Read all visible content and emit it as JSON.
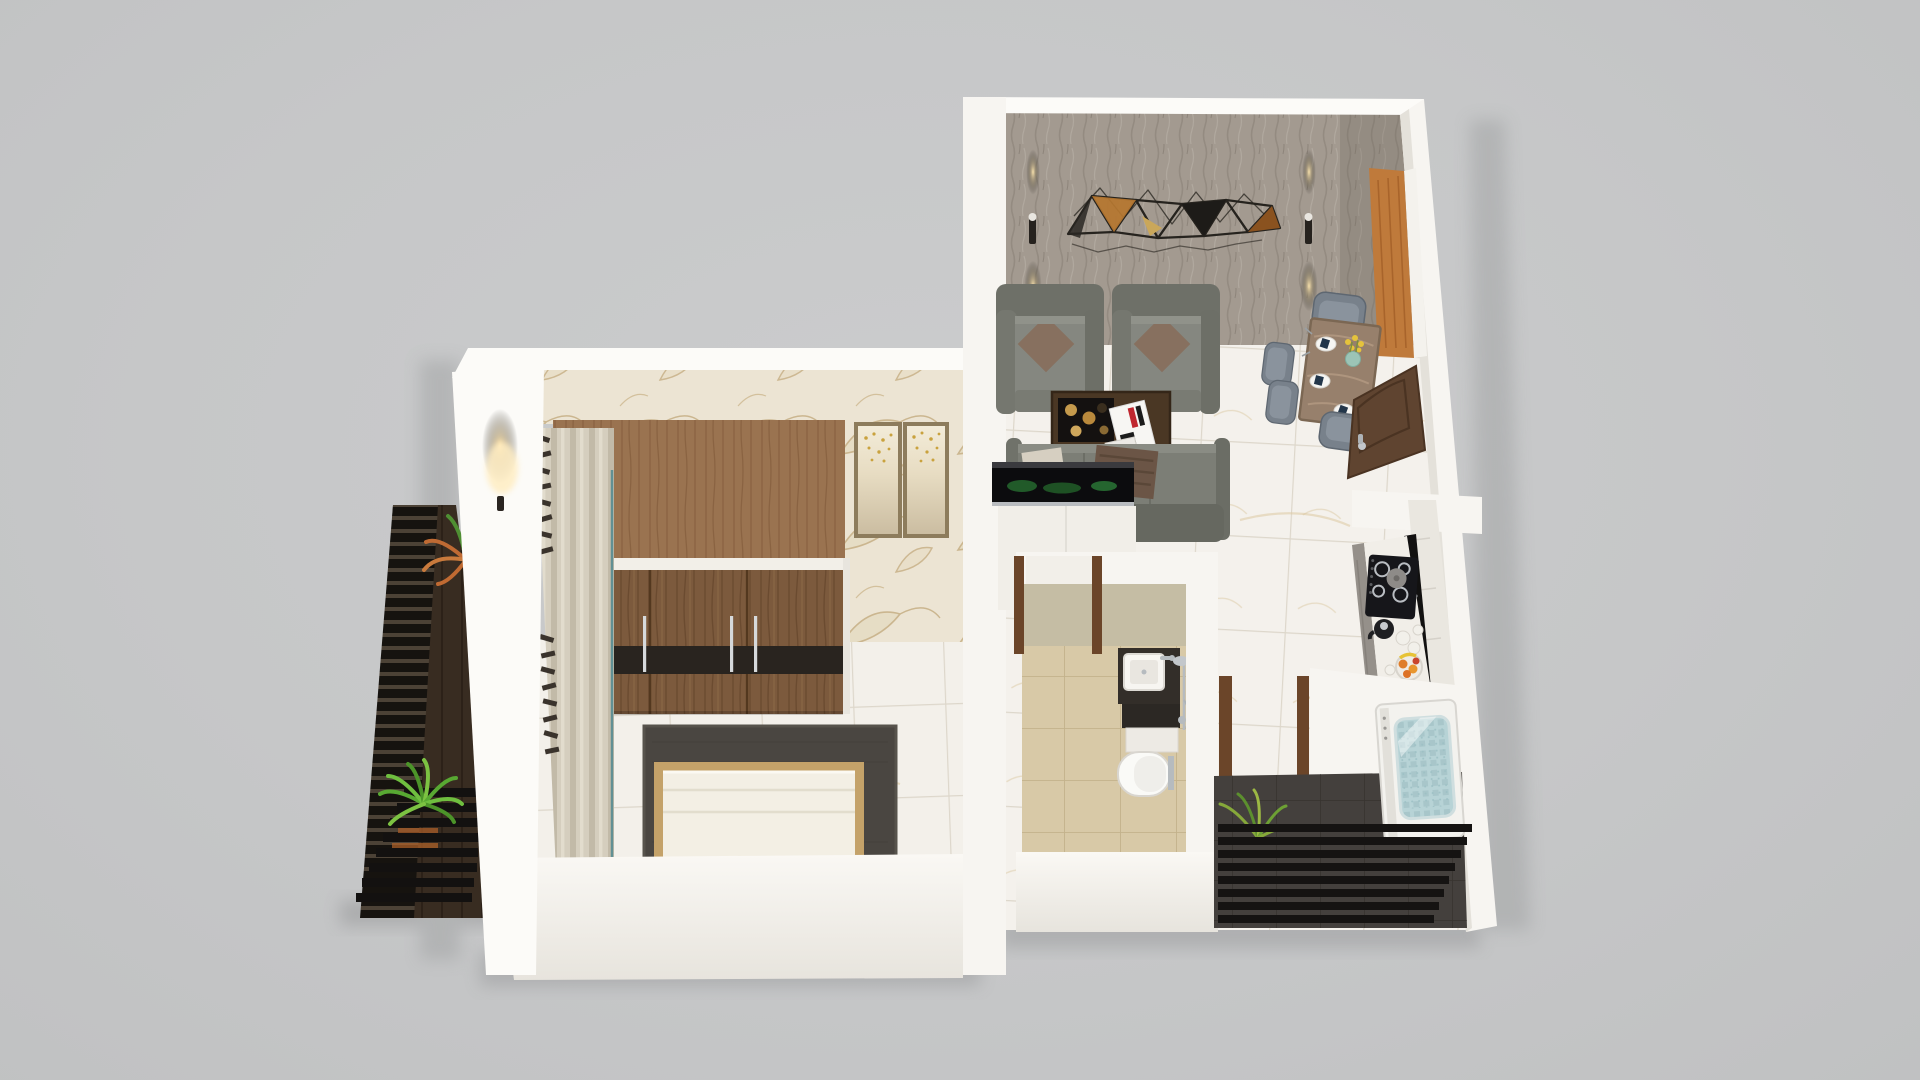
{
  "meta": {
    "title": "3D isometric floor plan render of a one-bedroom apartment",
    "view": "top-down isometric cutaway",
    "background_color": "#c6c7c8",
    "no_visible_text": true
  },
  "palette": {
    "background": "#c6c7c8",
    "walls": "#f7f5f1",
    "living_wallpaper": "#a39a90",
    "bedroom_wallpaper": "#ece4d3",
    "marble_floor": "#f4f1ec",
    "wardrobe_wood": "#7c5a3d",
    "sofa_gray": "#7c7e76",
    "accent_gold": "#c59a4c",
    "door_wood": "#5f4430",
    "bathroom_floor_beige": "#d8c9a7",
    "utility_floor_dark": "#44403d",
    "plant_green": "#58a832",
    "washing_machine_glass": "#b7d3d6",
    "sconce_glow": "#ffd9a0"
  },
  "rooms": {
    "living_room": {
      "label": "Living room with dining area",
      "features": [
        "textured gray feature wallpaper",
        "geometric metal wall art with copper panels",
        "two wall sconces with warm up-down glow",
        "white marble floor"
      ],
      "furniture": [
        "armchair",
        "armchair",
        "coffee table with candle tray and magazine",
        "three-seat sofa with cushions and throw",
        "media console with glass showcase",
        "dining table with place settings",
        "four dining chairs",
        "flower vase",
        "open wooden entry door"
      ]
    },
    "bedroom": {
      "label": "Bedroom",
      "features": [
        "floral beige wallpaper",
        "white marble floor",
        "floor-length curtains",
        "wall sconce on outer wall"
      ],
      "furniture": [
        "three-door wooden wardrobe with black accent band",
        "double bed with cream duvet",
        "dark gray rug",
        "two framed artworks"
      ]
    },
    "bathroom": {
      "label": "Bathroom",
      "features": [
        "beige tiled floor",
        "wooden door frames"
      ],
      "furniture": [
        "dark vanity with square washbasin",
        "chrome shower set",
        "wall-hung toilet",
        "storage drawer"
      ]
    },
    "kitchen": {
      "label": "Kitchen",
      "features": [
        "white marble counter",
        "marble backsplash",
        "black utensil rail"
      ],
      "furniture": [
        "black gas hob with pot",
        "kettle",
        "white canisters",
        "fruit bowl"
      ]
    },
    "utility_balcony": {
      "label": "Utility balcony",
      "features": [
        "dark tiled floor",
        "black slat railing",
        "grass plant"
      ],
      "furniture": [
        "top-load washing machine with glass lid"
      ]
    },
    "bedroom_balcony": {
      "label": "Bedroom balcony",
      "features": [
        "dark wood deck",
        "black slat railing",
        "two potted plants"
      ]
    },
    "hallway": {
      "label": "Hallway passage",
      "features": [
        "white marble floor",
        "wooden door frame to utility balcony"
      ]
    }
  }
}
